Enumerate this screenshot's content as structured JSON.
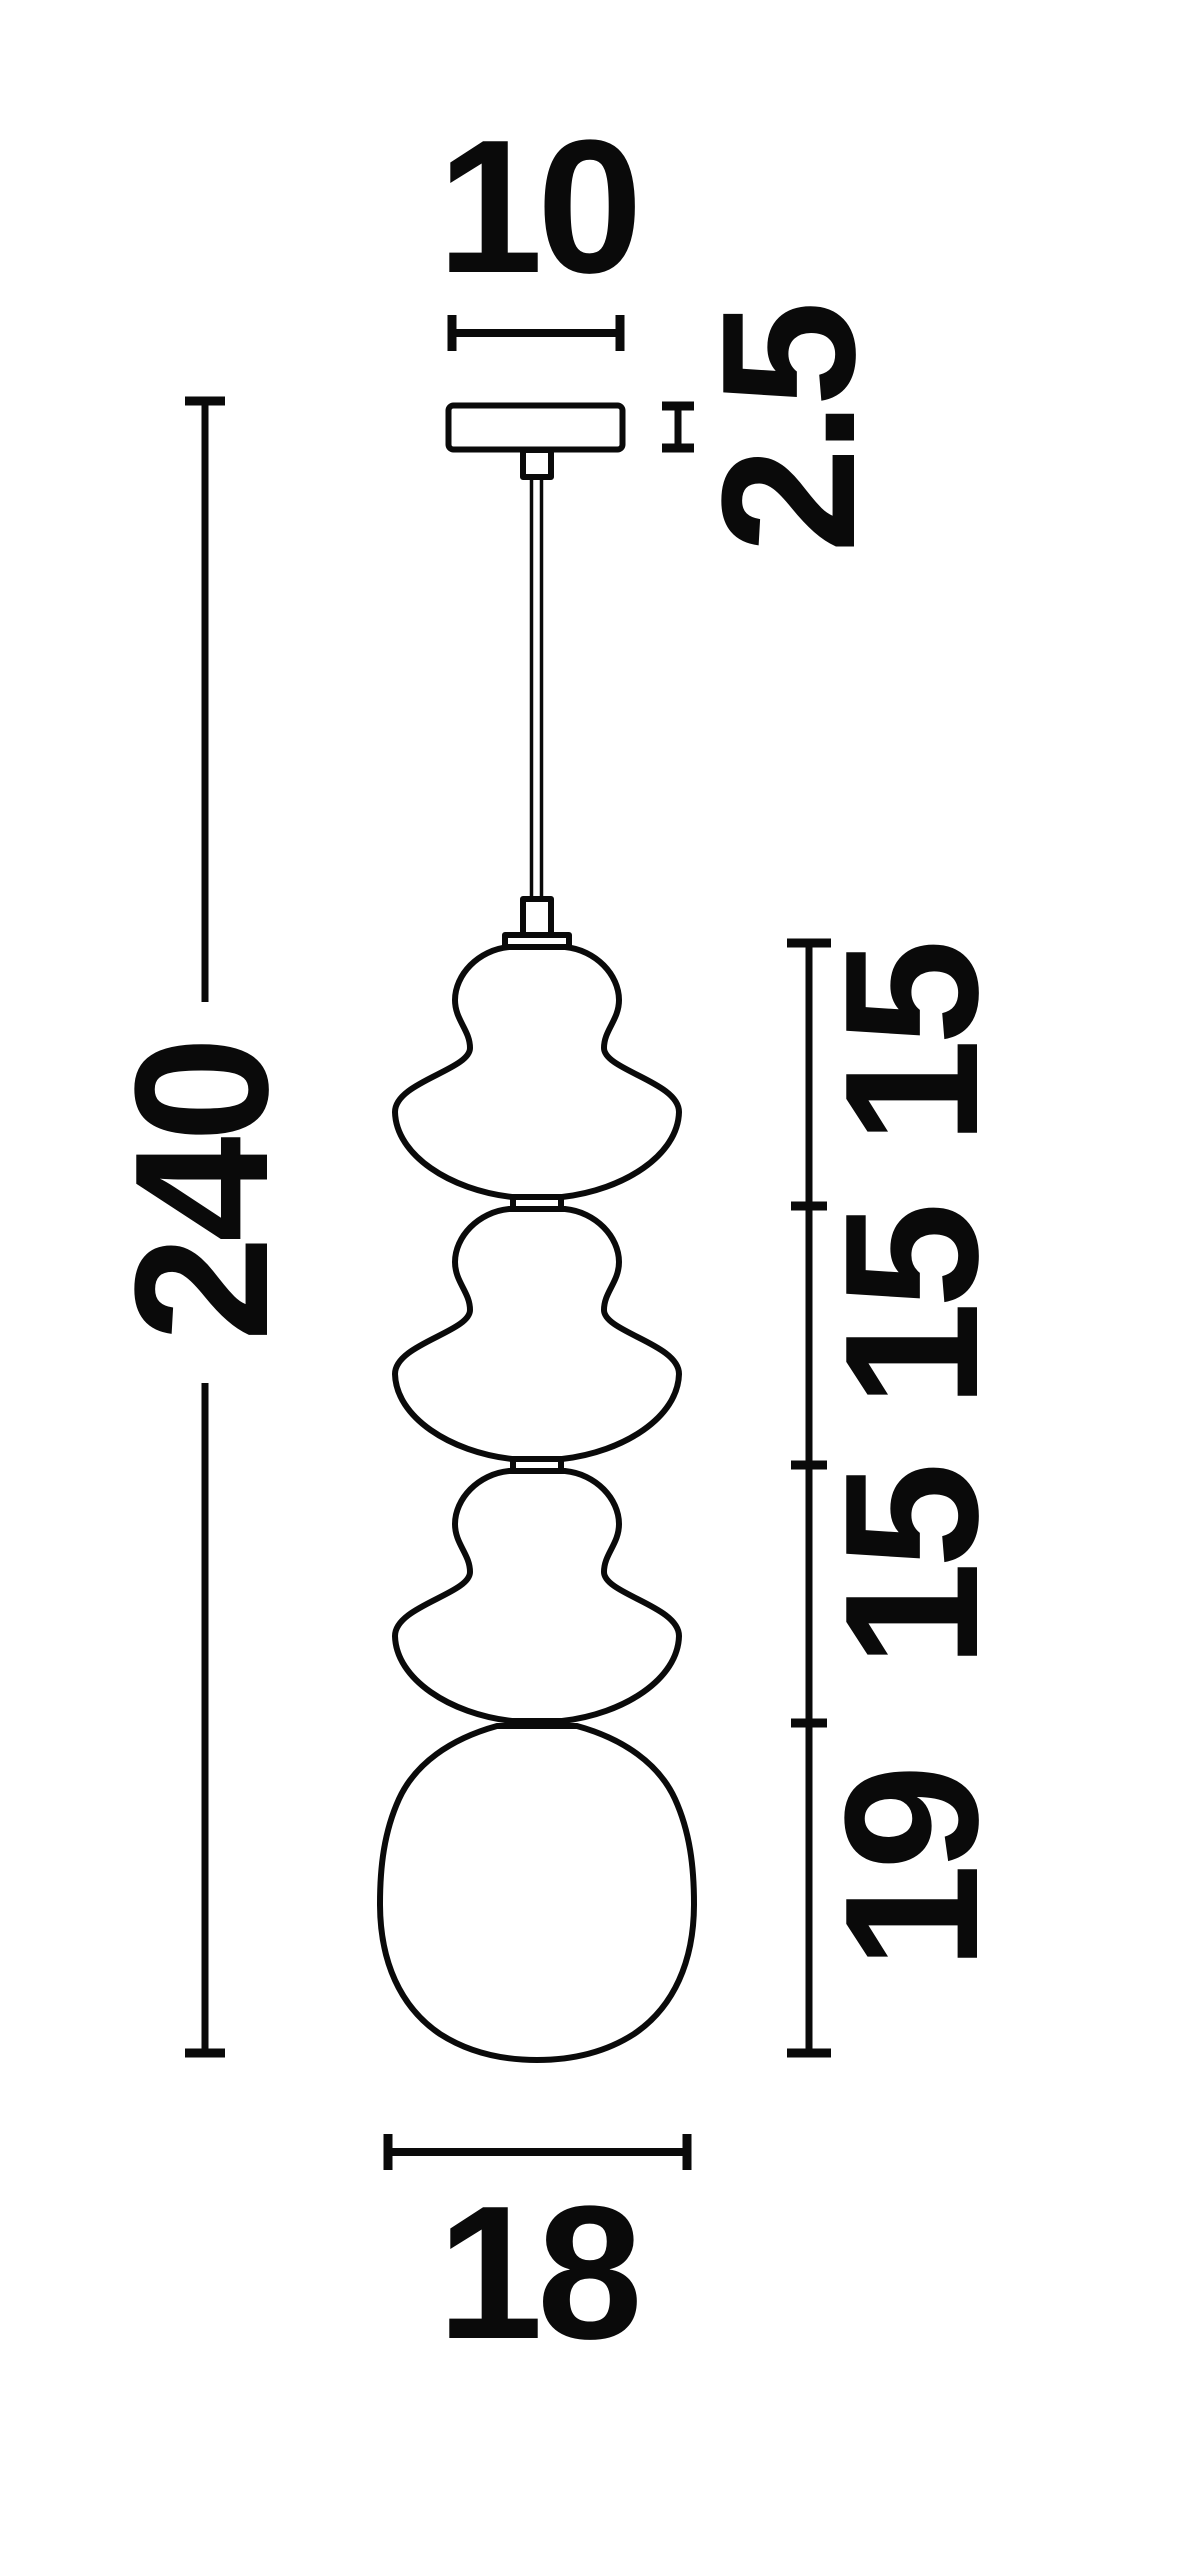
{
  "drawing": {
    "title": "pendant-lamp-dimension-diagram",
    "dimensions": {
      "canopy_width": "10",
      "canopy_thickness": "2.5",
      "overall_drop": "240",
      "shade_tier_1": "15",
      "shade_tier_2": "15",
      "shade_tier_3": "15",
      "bottom_globe_height": "19",
      "globe_width": "18"
    },
    "colors": {
      "ink": "#0a0a0a",
      "paper": "#ffffff"
    }
  }
}
